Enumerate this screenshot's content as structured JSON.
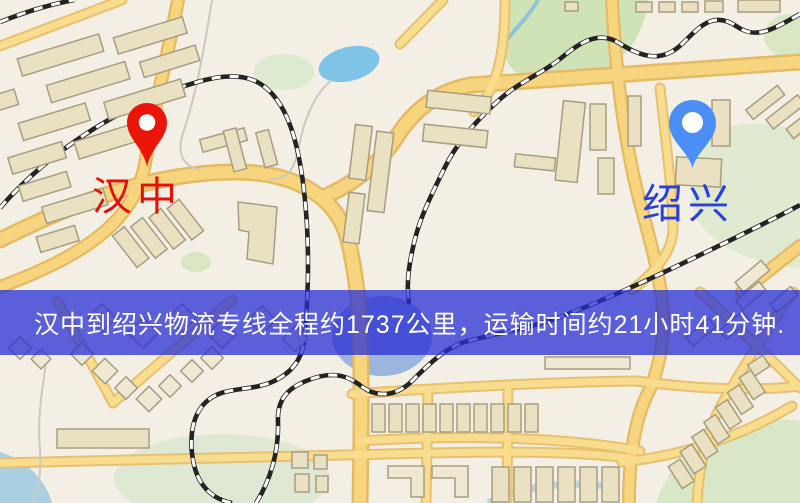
{
  "banner": {
    "text": "汉中到绍兴物流专线全程约1737公里，运输时间约21小时41分钟.",
    "background_color": "#282fd5",
    "text_color": "#ffffff"
  },
  "markers": {
    "origin": {
      "label": "汉中",
      "pin_color": "#ea1409",
      "label_color": "#e60f08"
    },
    "destination": {
      "label": "绍兴",
      "pin_color": "#4b8ef5",
      "label_color": "#2840e2"
    }
  },
  "route": {
    "origin": "汉中",
    "destination": "绍兴",
    "distance_km": 1737,
    "duration_hours": 21,
    "duration_minutes": 41
  },
  "map_colors": {
    "background": "#f3efe5",
    "road_fill": "#f6d57e",
    "road_casing": "#e6ba64",
    "building": "#eae1c3",
    "park": "#d9e7c9",
    "water": "#7fc3e6",
    "railway": "#232323"
  }
}
